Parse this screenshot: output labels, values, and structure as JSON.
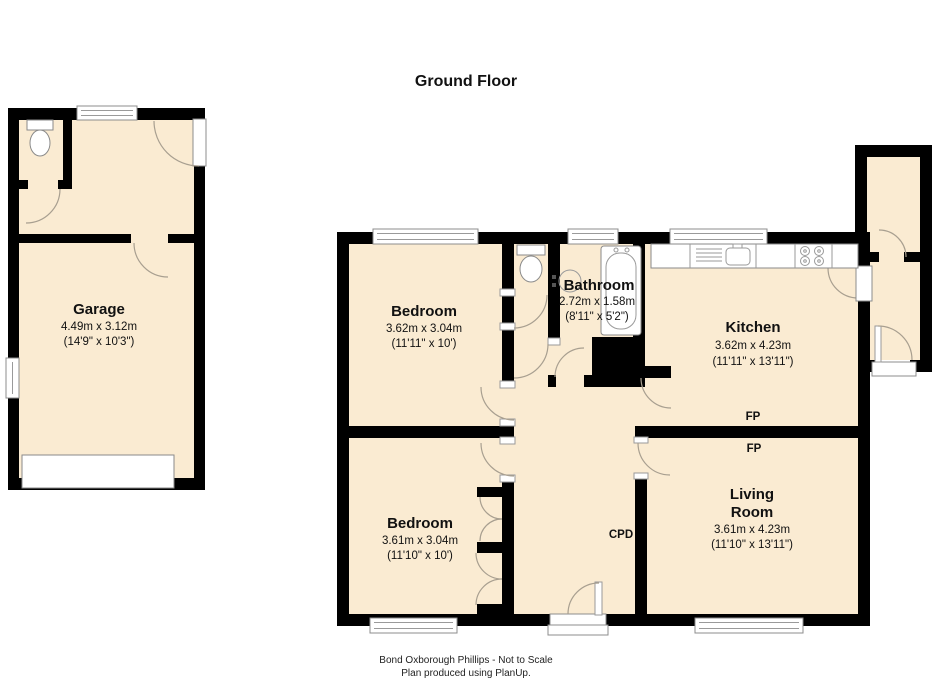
{
  "title": "Ground Floor",
  "footer": {
    "line1": "Bond Oxborough Phillips - Not to Scale",
    "line2": "Plan produced using PlanUp."
  },
  "rooms": {
    "garage": {
      "name": "Garage",
      "metric": "4.49m x 3.12m",
      "imperial": "(14'9\" x 10'3\")"
    },
    "bedroom_top": {
      "name": "Bedroom",
      "metric": "3.62m x 3.04m",
      "imperial": "(11'11\" x 10')"
    },
    "bathroom": {
      "name": "Bathroom",
      "metric": "2.72m x 1.58m",
      "imperial": "(8'11\" x 5'2\")"
    },
    "kitchen": {
      "name": "Kitchen",
      "metric": "3.62m x 4.23m",
      "imperial": "(11'11\" x 13'11\")"
    },
    "bedroom_bottom": {
      "name": "Bedroom",
      "metric": "3.61m x 3.04m",
      "imperial": "(11'10\" x 10')"
    },
    "living_room": {
      "line1": "Living",
      "line2": "Room",
      "metric": "3.61m x 4.23m",
      "imperial": "(11'10\" x 13'11\")"
    }
  },
  "annotations": {
    "fp": "FP",
    "cpd": "CPD"
  },
  "colors": {
    "floor": "#faebd2",
    "wall": "#000000",
    "fixture_trim": "#8c8c8c",
    "door_arc": "#a89f90"
  }
}
